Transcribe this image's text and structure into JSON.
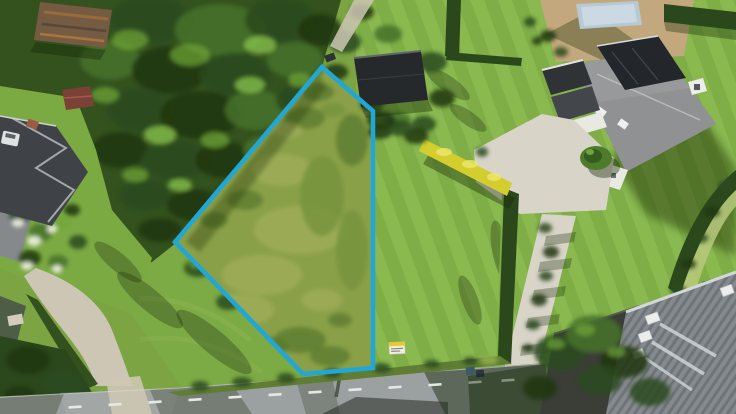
{
  "photo": {
    "kind": "aerial-drone-photograph",
    "subject": "Vacant grass building plot outlined in blue, surrounded by houses, gardens, hedges and a road",
    "width_px": 736,
    "height_px": 414
  },
  "boundary": {
    "points": "322,67 373,111 373,368 303,374 175,242",
    "stroke": "#21a7d6",
    "stroke_width": 4.5
  },
  "colors": {
    "base_grass": "#7ca443",
    "meadow": "#8aa048",
    "forest": "#33521d",
    "lawn_striped": "#7fae47",
    "lawn_sw": "#7caa44",
    "lawn_left": "#7baa43",
    "road": "#9ba0a0",
    "road_marking": "#e6e8e4",
    "gravel": "#cdc6b4",
    "driveway": "#d8d4c8",
    "hedge": "#2b481c",
    "hedge_yellow": "#d4cd2e",
    "roof_charcoal": "#3f4347",
    "roof_grey": "#8f9193",
    "roof_dark_shed": "#26292b",
    "wall_white": "#e9e9e4",
    "pool_cover": "#b6c9d4",
    "pool_deck": "#c4a87d",
    "rust_roof": "#745b42",
    "red_shed": "#7a4136",
    "shadow": "#142806",
    "sign_white": "#f1efe2",
    "sign_yellow": "#e3cc2d",
    "pond": "#2f5a56",
    "car_white": "#dfe0e0"
  },
  "road": {
    "shape": "0,397 180,388 330,377 470,369 545,363 552,414 0,414",
    "edge_points": "0,397 180,388 330,377 470,369 540,364",
    "dash_points": [
      [
        75,
        407
      ],
      [
        115,
        404.5
      ],
      [
        155,
        402
      ],
      [
        195,
        399.6
      ],
      [
        235,
        397.1
      ],
      [
        275,
        394.6
      ],
      [
        315,
        392.1
      ],
      [
        355,
        389.6
      ],
      [
        395,
        387.2
      ],
      [
        435,
        384.7
      ],
      [
        475,
        382.2
      ],
      [
        508,
        380.2
      ]
    ]
  },
  "texture": {
    "forest_blobs": [
      [
        150,
        20,
        40,
        24,
        "d2"
      ],
      [
        220,
        30,
        45,
        26,
        "m"
      ],
      [
        280,
        20,
        35,
        22,
        "d2"
      ],
      [
        110,
        60,
        30,
        20,
        "m"
      ],
      [
        170,
        70,
        38,
        24,
        "d1"
      ],
      [
        235,
        75,
        36,
        22,
        "d2"
      ],
      [
        295,
        60,
        28,
        18,
        "m"
      ],
      [
        320,
        30,
        22,
        16,
        "d1"
      ],
      [
        140,
        110,
        34,
        22,
        "d2"
      ],
      [
        200,
        115,
        40,
        24,
        "d1"
      ],
      [
        255,
        110,
        30,
        20,
        "m"
      ],
      [
        300,
        100,
        24,
        16,
        "d2"
      ],
      [
        120,
        150,
        28,
        18,
        "d1"
      ],
      [
        175,
        160,
        34,
        20,
        "d2"
      ],
      [
        225,
        160,
        30,
        18,
        "d1"
      ],
      [
        265,
        150,
        22,
        14,
        "m"
      ],
      [
        145,
        195,
        26,
        16,
        "d2"
      ],
      [
        195,
        205,
        28,
        16,
        "d1"
      ],
      [
        230,
        195,
        20,
        12,
        "d2"
      ],
      [
        160,
        230,
        22,
        12,
        "d1"
      ],
      [
        130,
        40,
        18,
        10,
        "l"
      ],
      [
        190,
        55,
        20,
        11,
        "l"
      ],
      [
        260,
        45,
        16,
        9,
        "xl"
      ],
      [
        105,
        95,
        14,
        8,
        "l"
      ],
      [
        160,
        135,
        16,
        9,
        "xl"
      ],
      [
        215,
        140,
        14,
        8,
        "l"
      ],
      [
        250,
        85,
        15,
        8,
        "xl"
      ],
      [
        300,
        80,
        12,
        7,
        "l"
      ],
      [
        135,
        175,
        13,
        7,
        "l"
      ],
      [
        180,
        185,
        12,
        6,
        "xl"
      ],
      [
        210,
        225,
        12,
        6,
        "l"
      ],
      [
        198,
        268,
        14,
        9,
        "d2"
      ],
      [
        228,
        302,
        12,
        8,
        "d2"
      ],
      [
        195,
        264,
        6,
        4,
        "l"
      ],
      [
        345,
        42,
        16,
        11,
        "d2"
      ],
      [
        388,
        34,
        14,
        9,
        "m"
      ],
      [
        336,
        72,
        12,
        8,
        "d1"
      ],
      [
        362,
        12,
        12,
        8,
        "d1"
      ]
    ],
    "east_trees": [
      [
        432,
        62,
        15,
        10,
        "d2"
      ],
      [
        442,
        98,
        13,
        9,
        "d1"
      ],
      [
        424,
        124,
        12,
        8,
        "d2"
      ],
      [
        398,
        120,
        13,
        8,
        "m"
      ],
      [
        380,
        132,
        12,
        7,
        "d1"
      ],
      [
        372,
        104,
        12,
        8,
        "d2"
      ],
      [
        416,
        136,
        12,
        8,
        "d1"
      ],
      [
        400,
        128,
        13,
        8,
        "d2"
      ],
      [
        381,
        120,
        14,
        9,
        "d1"
      ]
    ],
    "plot_blobs": [
      [
        265,
        95,
        26,
        13,
        "pm-d"
      ],
      [
        305,
        118,
        20,
        11,
        "pm-d"
      ],
      [
        232,
        128,
        22,
        12,
        "pm-d"
      ],
      [
        210,
        165,
        20,
        11,
        "pm-d"
      ],
      [
        318,
        92,
        16,
        9,
        "pm-d"
      ],
      [
        352,
        140,
        16,
        26,
        "pm-d"
      ],
      [
        245,
        200,
        18,
        10,
        "pm-d"
      ],
      [
        282,
        170,
        30,
        16,
        "pm-l"
      ],
      [
        300,
        230,
        46,
        24,
        "pm-l"
      ],
      [
        262,
        275,
        40,
        20,
        "pm-l"
      ],
      [
        240,
        310,
        34,
        16,
        "pm-l"
      ],
      [
        322,
        196,
        22,
        40,
        "pm-m"
      ],
      [
        352,
        250,
        16,
        40,
        "pm-m"
      ],
      [
        300,
        340,
        26,
        13,
        "pm-d"
      ],
      [
        330,
        356,
        20,
        10,
        "pm-d"
      ],
      [
        272,
        346,
        16,
        9,
        "pm-d"
      ],
      [
        214,
        220,
        14,
        8,
        "pm-d"
      ],
      [
        322,
        300,
        20,
        11,
        "pm-l"
      ],
      [
        288,
        130,
        14,
        8,
        "pm-l"
      ],
      [
        340,
        320,
        12,
        7,
        "pm-d"
      ],
      [
        310,
        70,
        14,
        8,
        "pm-d"
      ],
      [
        333,
        110,
        12,
        7,
        "pm-m"
      ]
    ],
    "garden_blobs": [
      [
        20,
        215,
        11,
        8,
        "d2"
      ],
      [
        41,
        232,
        12,
        9,
        "m"
      ],
      [
        62,
        222,
        9,
        7,
        "l"
      ],
      [
        30,
        258,
        11,
        8,
        "d1"
      ],
      [
        58,
        262,
        10,
        7,
        "m"
      ],
      [
        78,
        242,
        9,
        7,
        "d2"
      ],
      [
        72,
        210,
        8,
        6,
        "d1"
      ],
      [
        18,
        223,
        6,
        4,
        "fl"
      ],
      [
        34,
        241,
        7,
        5,
        "fl"
      ],
      [
        52,
        229,
        5,
        4,
        "fl"
      ],
      [
        27,
        266,
        6,
        4,
        "fl"
      ],
      [
        57,
        269,
        5,
        4,
        "fl"
      ],
      [
        44,
        219,
        4,
        3,
        "fl"
      ]
    ],
    "forest_south": [
      [
        28,
        360,
        22,
        14,
        "d1"
      ],
      [
        64,
        384,
        20,
        13,
        "d2"
      ],
      [
        20,
        396,
        16,
        10,
        "d1"
      ],
      [
        88,
        402,
        14,
        9,
        "d2"
      ]
    ],
    "verge_blobs": [
      [
        200,
        386,
        9,
        5,
        "d2"
      ],
      [
        242,
        382,
        10,
        5,
        "d2"
      ],
      [
        286,
        378,
        9,
        5,
        "d2"
      ],
      [
        332,
        373,
        9,
        5,
        "d2"
      ],
      [
        382,
        368,
        9,
        5,
        "d2"
      ],
      [
        432,
        364,
        8,
        4,
        "d2"
      ],
      [
        470,
        361,
        7,
        4,
        "d2"
      ],
      [
        489,
        360,
        9,
        5,
        "vl"
      ]
    ],
    "canopy_blobs": [
      [
        560,
        352,
        26,
        18,
        "d2"
      ],
      [
        594,
        334,
        28,
        19,
        "m"
      ],
      [
        624,
        362,
        24,
        16,
        "d1"
      ],
      [
        650,
        392,
        20,
        14,
        "d2"
      ],
      [
        540,
        388,
        17,
        12,
        "d1"
      ],
      [
        600,
        380,
        22,
        15,
        "d2"
      ],
      [
        585,
        330,
        10,
        6,
        "l"
      ],
      [
        616,
        352,
        9,
        5,
        "l"
      ],
      [
        556,
        344,
        9,
        5,
        "l"
      ]
    ],
    "lane_bushes": [
      [
        545,
        228,
        7,
        5,
        "d2"
      ],
      [
        551,
        252,
        8,
        6,
        "d1"
      ],
      [
        546,
        276,
        7,
        5,
        "d2"
      ],
      [
        539,
        300,
        8,
        6,
        "d1"
      ],
      [
        533,
        325,
        7,
        5,
        "d2"
      ],
      [
        528,
        348,
        6,
        4,
        "d1"
      ],
      [
        482,
        152,
        6,
        5,
        "d2"
      ]
    ],
    "pool_bushes": [
      [
        548,
        36,
        8,
        6,
        "d1"
      ],
      [
        561,
        52,
        7,
        5,
        "d2"
      ],
      [
        530,
        22,
        6,
        5,
        "d2"
      ],
      [
        537,
        41,
        5,
        4,
        "d1"
      ]
    ],
    "edge_hedge_blobs": [
      [
        726,
        186,
        8,
        5,
        "d2"
      ],
      [
        712,
        212,
        8,
        5,
        "d1"
      ],
      [
        700,
        238,
        8,
        5,
        "d2"
      ],
      [
        688,
        264,
        8,
        5,
        "d1"
      ],
      [
        678,
        290,
        8,
        5,
        "d2"
      ],
      [
        670,
        312,
        7,
        4,
        "d1"
      ]
    ],
    "lawn_shadows": [
      [
        150,
        300,
        42,
        11,
        "sh",
        40
      ],
      [
        214,
        342,
        48,
        12,
        "sh",
        40
      ],
      [
        118,
        262,
        30,
        9,
        "sh",
        40
      ],
      [
        448,
        84,
        26,
        8,
        "sh",
        35
      ],
      [
        468,
        118,
        22,
        7,
        "sh",
        35
      ],
      [
        500,
        250,
        30,
        8,
        "sh",
        80
      ],
      [
        470,
        300,
        26,
        8,
        "sh",
        70
      ]
    ]
  },
  "scene": {
    "features": [
      "rough grass plot with blue cadastral boundary line",
      "dense woodland north-west of the plot",
      "neighbouring house with dark hip roof and white car (west)",
      "rusty-roofed shed in trees (north-west corner)",
      "house with grey roof, white walls, gravel courtyard and covered swimming pool (north-east)",
      "bright yellow hedge and clipped dark hedges along the east side",
      "gravel driveway connecting courtyard to the road",
      "modern grey ribbed-roof house with skylights (south-east corner)",
      "asphalt road with dashed white centre line along the south",
      "small white and yellow sale sign at the roadside",
      "garden with white flowering shrubs and gravel path (south-west)"
    ]
  }
}
